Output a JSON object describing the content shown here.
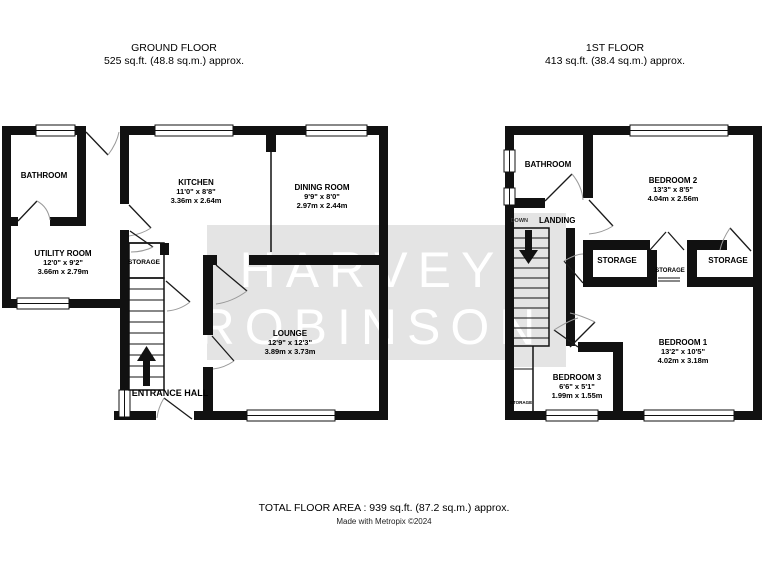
{
  "titles": {
    "ground": {
      "line1": "GROUND FLOOR",
      "line2": "525 sq.ft. (48.8 sq.m.) approx."
    },
    "first": {
      "line1": "1ST FLOOR",
      "line2": "413 sq.ft. (38.4 sq.m.) approx."
    }
  },
  "watermark": {
    "line1": "HARVEY",
    "line2": "ROBINSON",
    "band_color": "#e4e4e4",
    "text_color": "#ffffff"
  },
  "ground": {
    "bathroom": {
      "name": "BATHROOM"
    },
    "utility": {
      "name": "UTILITY ROOM",
      "imperial": "12'0\" x 9'2\"",
      "metric": "3.66m x 2.79m"
    },
    "kitchen": {
      "name": "KITCHEN",
      "imperial": "11'0\" x 8'8\"",
      "metric": "3.36m x 2.64m"
    },
    "dining": {
      "name": "DINING ROOM",
      "imperial": "9'9\" x 8'0\"",
      "metric": "2.97m x 2.44m"
    },
    "lounge": {
      "name": "LOUNGE",
      "imperial": "12'9\" x 12'3\"",
      "metric": "3.89m x 3.73m"
    },
    "storage": {
      "name": "STORAGE"
    },
    "entrance_hall": {
      "name": "ENTRANCE HALL"
    }
  },
  "first": {
    "bathroom": {
      "name": "BATHROOM"
    },
    "landing": {
      "name": "LANDING",
      "direction": "DOWN"
    },
    "bedroom2": {
      "name": "BEDROOM 2",
      "imperial": "13'3\" x 8'5\"",
      "metric": "4.04m x 2.56m"
    },
    "bedroom1": {
      "name": "BEDROOM 1",
      "imperial": "13'2\" x 10'5\"",
      "metric": "4.02m x 3.18m"
    },
    "bedroom3": {
      "name": "BEDROOM 3",
      "imperial": "6'6\" x 5'1\"",
      "metric": "1.99m x 1.55m"
    },
    "storage_left": {
      "name": "STORAGE"
    },
    "storage_middle": {
      "name": "STORAGE"
    },
    "storage_right": {
      "name": "STORAGE"
    },
    "storage_understairs": {
      "name": "STORAGE"
    }
  },
  "footer": {
    "total_area": "TOTAL FLOOR AREA : 939 sq.ft. (87.2 sq.m.) approx.",
    "credit": "Made with Metropix ©2024"
  },
  "colors": {
    "wall": "#111111",
    "background": "#ffffff"
  }
}
